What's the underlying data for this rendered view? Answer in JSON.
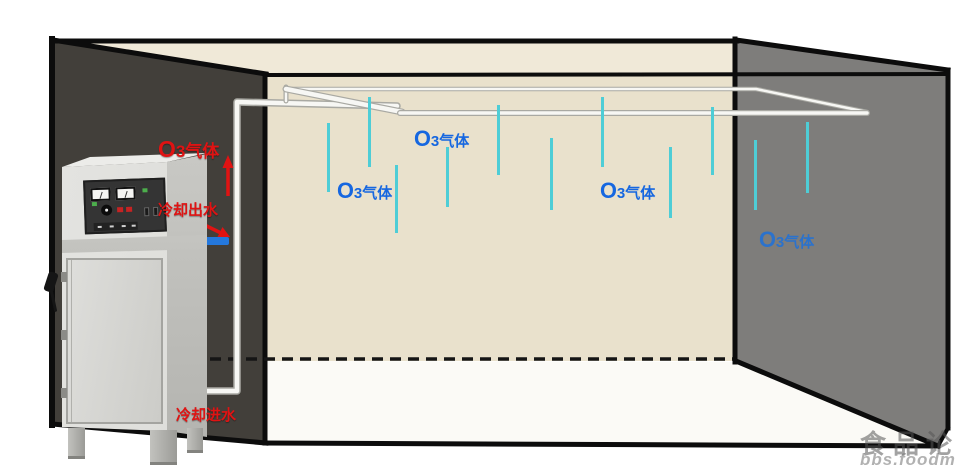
{
  "colors": {
    "wall_left": "#423f3a",
    "wall_back": "#e9e1cc",
    "ceiling": "#f0e9d8",
    "wall_right": "#7e7d7b",
    "floor": "#fbfaf6",
    "outline": "#0c0c0c",
    "pipe": "#f7f7f4",
    "pipe_edge": "#a9a9a3",
    "gas_drop": "#4ecdd6",
    "label_blue": "#1667e0",
    "label_red": "#e01313",
    "fitting_blue": "#2478dd"
  },
  "machine": {
    "name": "ozone-generator-cabinet",
    "labels": {
      "gas_out": "O3气体",
      "water_out": "冷却出水",
      "water_in": "冷却进水"
    }
  },
  "room": {
    "gas_labels": [
      {
        "text": "O3气体",
        "x": 414,
        "y": 126,
        "color": "#1667e0"
      },
      {
        "text": "O3气体",
        "x": 337,
        "y": 178,
        "color": "#1667e0"
      },
      {
        "text": "O3气体",
        "x": 600,
        "y": 178,
        "color": "#1667e0"
      },
      {
        "text": "O3气体",
        "x": 759,
        "y": 227,
        "color": "#2b72cc"
      }
    ],
    "gas_drops": [
      {
        "x": 328,
        "y1": 123,
        "y2": 192
      },
      {
        "x": 369,
        "y1": 97,
        "y2": 167
      },
      {
        "x": 396,
        "y1": 165,
        "y2": 233
      },
      {
        "x": 447,
        "y1": 147,
        "y2": 207
      },
      {
        "x": 498,
        "y1": 105,
        "y2": 175
      },
      {
        "x": 551,
        "y1": 138,
        "y2": 210
      },
      {
        "x": 602,
        "y1": 97,
        "y2": 167
      },
      {
        "x": 670,
        "y1": 147,
        "y2": 218
      },
      {
        "x": 712,
        "y1": 107,
        "y2": 175
      },
      {
        "x": 755,
        "y1": 140,
        "y2": 210
      },
      {
        "x": 807,
        "y1": 122,
        "y2": 193
      }
    ]
  },
  "watermark": {
    "line1": "食品论",
    "line2": "bbs.foodma"
  }
}
